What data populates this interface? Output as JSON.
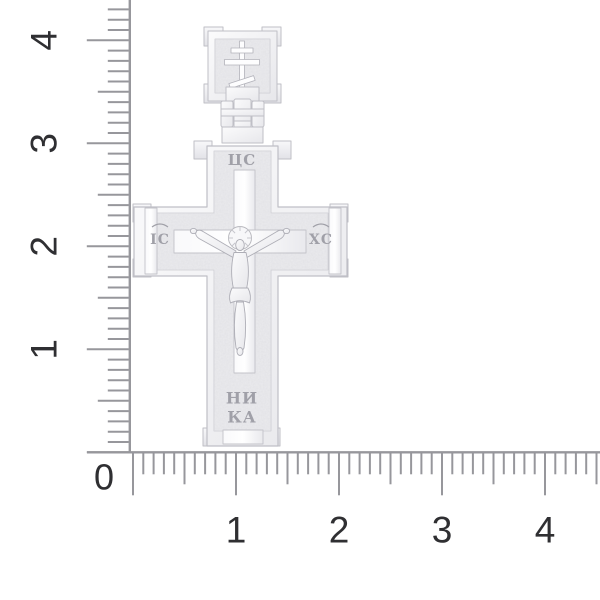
{
  "product": {
    "name": "silver orthodox crucifix cross pendant",
    "inscriptions": {
      "top": "ЦС",
      "left_arm": "ІС",
      "right_arm": "ХС",
      "bottom_line1": "НИ",
      "bottom_line2": "КА"
    }
  },
  "rulers": {
    "origin_label": "0",
    "vertical": {
      "tick_count": 44,
      "labels": [
        {
          "text": "4",
          "unit": 4
        },
        {
          "text": "3",
          "unit": 3
        },
        {
          "text": "2",
          "unit": 2
        },
        {
          "text": "1",
          "unit": 1
        }
      ]
    },
    "horizontal": {
      "tick_count": 46,
      "labels": [
        {
          "text": "1",
          "unit": 1
        },
        {
          "text": "2",
          "unit": 2
        },
        {
          "text": "3",
          "unit": 3
        },
        {
          "text": "4",
          "unit": 4
        }
      ]
    }
  },
  "colors": {
    "background": "#ffffff",
    "tick": "#97979c",
    "number": "#2f2f32",
    "silver_base": "#f3f3f5",
    "silver_texture": "#ebebee",
    "silver_outline": "#bfbfc6",
    "engraving": "#a0a0a8"
  }
}
